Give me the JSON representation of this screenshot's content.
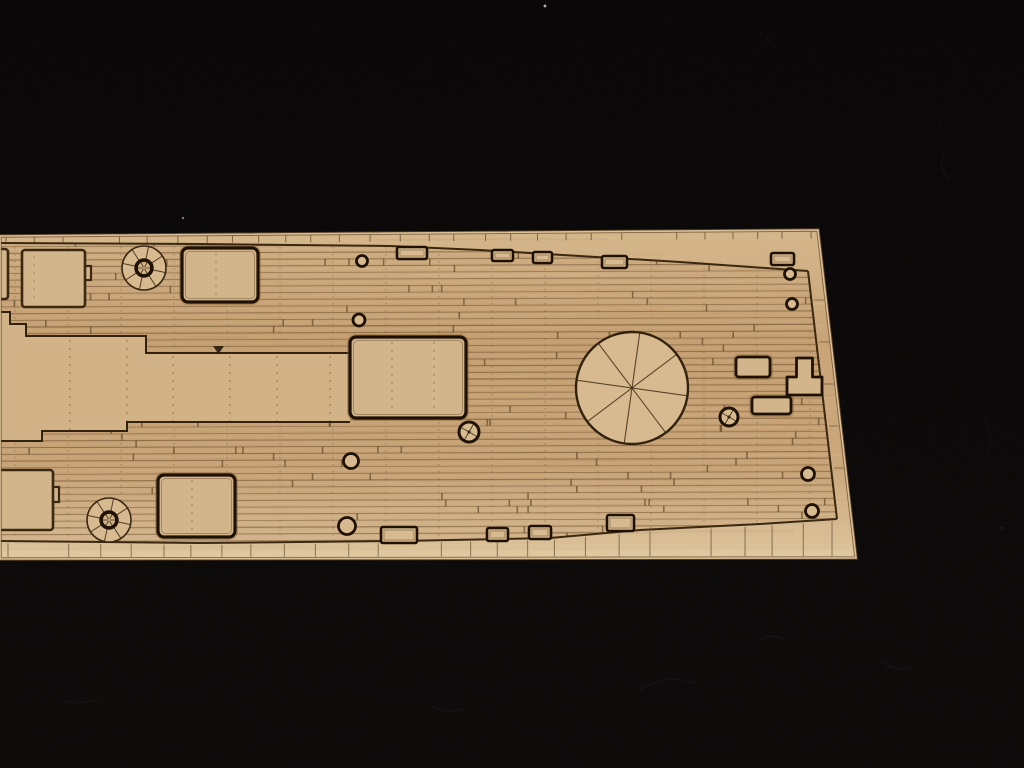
{
  "meta": {
    "description": "Close-up photograph of a laser-etched wooden model ship deck sheet lying on black fabric"
  },
  "scene": {
    "canvas": {
      "width": 1024,
      "height": 768,
      "background": "#060304",
      "background_low": "#0a0707"
    },
    "specks": [
      {
        "x": 545,
        "y": 6,
        "r": 1.4,
        "color": "#ccd3ce",
        "o": 0.85
      },
      {
        "x": 183,
        "y": 218,
        "r": 1.1,
        "color": "#b9a98c",
        "o": 0.8
      },
      {
        "x": 768,
        "y": 40,
        "r": 0.9,
        "color": "#3c3438",
        "o": 0.8
      },
      {
        "x": 1002,
        "y": 528,
        "r": 1.0,
        "color": "#3a3136",
        "o": 0.7
      },
      {
        "x": 120,
        "y": 648,
        "r": 1.0,
        "color": "#332c30",
        "o": 0.6
      },
      {
        "x": 940,
        "y": 126,
        "r": 0.8,
        "color": "#342d31",
        "o": 0.6
      }
    ],
    "fuzz": [
      {
        "d": "M640,690 q30,-18 55,-6"
      },
      {
        "d": "M430,705 q18,10 36,3"
      },
      {
        "d": "M880,660 q14,12 30,8"
      },
      {
        "d": "M985,420 q10,18 2,34"
      },
      {
        "d": "M60,700 q22,6 40,-2"
      },
      {
        "d": "M945,150 q-8,16 4,30"
      },
      {
        "d": "M760,640 q16,-8 28,2"
      }
    ],
    "fuzz_color": "#241f22",
    "wood": {
      "outline": [
        [
          0,
          236
        ],
        [
          818,
          230
        ],
        [
          856,
          558
        ],
        [
          0,
          559
        ]
      ],
      "gradient": [
        "#d5b78c",
        "#c8a477",
        "#cba87c",
        "#ddc39c"
      ],
      "edge_stroke": "#e6cca3",
      "edge_dark": "#6b4e2d",
      "bottom_face": [
        [
          0,
          551
        ],
        [
          856,
          550
        ],
        [
          856,
          559
        ],
        [
          0,
          560
        ]
      ],
      "bottom_face_color": "#e0c8a2",
      "grain_light": "#ecd7b2",
      "grain_dark": "#9d7950",
      "grain_count": 90,
      "grain_seed": 7
    },
    "deck": {
      "top": [
        [
          0,
          243
        ],
        [
          200,
          244
        ],
        [
          390,
          246
        ],
        [
          480,
          250
        ],
        [
          563,
          255
        ],
        [
          680,
          262
        ],
        [
          808,
          271
        ]
      ],
      "right": [
        [
          808,
          271
        ],
        [
          837,
          519
        ]
      ],
      "bottom": [
        [
          0,
          541
        ],
        [
          200,
          543
        ],
        [
          400,
          541
        ],
        [
          550,
          538
        ],
        [
          640,
          530
        ],
        [
          760,
          524
        ],
        [
          837,
          519
        ]
      ],
      "line_color": "#3a2810",
      "plank": {
        "spacing": 6.7,
        "top_y": 240,
        "bottom_y": 552,
        "seam_color": "#6e5231",
        "light_color": "#e4c99e",
        "tint_color": "#b08457",
        "tint_opacity": 0.16,
        "butt_color": "#4a3315",
        "butt_count": 170,
        "butt_seed": 3,
        "dot_col_step": 53,
        "dot_col_color": "#5d4223"
      }
    },
    "band": {
      "top_path": [
        [
          0,
          312
        ],
        [
          10,
          312
        ],
        [
          10,
          324
        ],
        [
          26,
          324
        ],
        [
          26,
          336
        ],
        [
          146,
          336
        ],
        [
          146,
          353
        ],
        [
          350,
          353
        ]
      ],
      "bottom_path": [
        [
          0,
          441
        ],
        [
          42,
          441
        ],
        [
          42,
          431
        ],
        [
          127,
          431
        ],
        [
          127,
          422
        ],
        [
          350,
          422
        ]
      ],
      "fill": "#d2b388",
      "outline": "#33220e",
      "dash_cols": [
        70,
        127,
        173,
        230,
        277,
        330
      ],
      "dash_color": "#6b4d2a"
    },
    "ticks": {
      "color": "#4f3a1e",
      "top_step": 24,
      "bottom_step": 26,
      "len": 7,
      "seed": 11
    },
    "etch": {
      "line": "#3a2810",
      "deep": "#1f1204",
      "halo": "#8a6434",
      "inner": "#6b4d2a",
      "fill": "#d3b58b",
      "fill_light": "#d7ba90"
    },
    "features": [
      {
        "type": "prect",
        "name": "etched-rect-left-edge-top",
        "x": -16,
        "y": 249,
        "w": 24,
        "h": 50
      },
      {
        "type": "hrect",
        "name": "etched-deckhouse-topleft",
        "x": 22,
        "y": 250,
        "w": 63,
        "h": 57,
        "bump": [
          82,
          266,
          9,
          14
        ]
      },
      {
        "type": "capstan",
        "name": "etched-capstan-fore",
        "cx": 144,
        "cy": 268,
        "r": 22
      },
      {
        "type": "hatch",
        "name": "etched-hatch-topmid",
        "x": 182,
        "y": 248,
        "w": 76,
        "h": 54,
        "dash_cols": [
          216
        ]
      },
      {
        "type": "ring",
        "name": "etched-ringbolt",
        "cx": 362,
        "cy": 261,
        "r": 5.5
      },
      {
        "type": "ring",
        "name": "etched-ringbolt",
        "cx": 359,
        "cy": 320,
        "r": 6
      },
      {
        "type": "edgerect",
        "name": "etched-fitting-topedge",
        "x": 397,
        "y": 247,
        "w": 30,
        "h": 12
      },
      {
        "type": "edgerect",
        "name": "etched-fitting-topedge",
        "x": 492,
        "y": 250,
        "w": 21,
        "h": 11
      },
      {
        "type": "edgerect",
        "name": "etched-fitting-topedge",
        "x": 533,
        "y": 252,
        "w": 19,
        "h": 11
      },
      {
        "type": "edgerect",
        "name": "etched-fitting-topedge",
        "x": 602,
        "y": 256,
        "w": 25,
        "h": 12
      },
      {
        "type": "edgerect",
        "name": "etched-fitting-topedge",
        "x": 771,
        "y": 253,
        "w": 23,
        "h": 12
      },
      {
        "type": "hatch",
        "name": "etched-central-hatch",
        "x": 350,
        "y": 337,
        "w": 116,
        "h": 81,
        "dash_cols": [
          392,
          434
        ]
      },
      {
        "type": "blob",
        "name": "etched-notch",
        "x": 213,
        "y": 346,
        "w": 11,
        "h": 8
      },
      {
        "type": "barbette",
        "name": "etched-barbette-circle",
        "cx": 632,
        "cy": 388,
        "r": 56
      },
      {
        "type": "winch",
        "name": "etched-winch",
        "cx": 469,
        "cy": 432,
        "r": 10
      },
      {
        "type": "winch",
        "name": "etched-winch",
        "cx": 729,
        "cy": 417,
        "r": 9
      },
      {
        "type": "ring",
        "name": "etched-ringbolt",
        "cx": 790,
        "cy": 274,
        "r": 5.5
      },
      {
        "type": "ring",
        "name": "etched-ringbolt",
        "cx": 792,
        "cy": 304,
        "r": 5.5
      },
      {
        "type": "rect2",
        "name": "etched-fitting-right",
        "x": 736,
        "y": 357,
        "w": 34,
        "h": 20
      },
      {
        "type": "rect2",
        "name": "etched-fitting-right",
        "x": 752,
        "y": 397,
        "w": 39,
        "h": 17
      },
      {
        "type": "tee",
        "name": "etched-tee-fitting",
        "x": 787,
        "y": 358,
        "stem_w": 16,
        "stem_h": 19,
        "base_w": 35,
        "base_h": 18
      },
      {
        "type": "ring",
        "name": "etched-ringbolt",
        "cx": 808,
        "cy": 474,
        "r": 6.5
      },
      {
        "type": "ring",
        "name": "etched-ringbolt",
        "cx": 812,
        "cy": 511,
        "r": 6.5
      },
      {
        "type": "ring",
        "name": "etched-ringbolt",
        "cx": 351,
        "cy": 461,
        "r": 7.5
      },
      {
        "type": "ring",
        "name": "etched-ringbolt",
        "cx": 347,
        "cy": 526,
        "r": 8.5
      },
      {
        "type": "hrect",
        "name": "etched-deckhouse-bottomleft",
        "x": -16,
        "y": 470,
        "w": 69,
        "h": 60,
        "bump": [
          50,
          487,
          9,
          15
        ]
      },
      {
        "type": "capstan",
        "name": "etched-capstan-aft",
        "cx": 109,
        "cy": 520,
        "r": 22
      },
      {
        "type": "hatch",
        "name": "etched-hatch-bottomleft",
        "x": 158,
        "y": 475,
        "w": 77,
        "h": 62,
        "dash_cols": [
          192
        ]
      },
      {
        "type": "edgerect",
        "name": "etched-fitting-bottomedge",
        "x": 381,
        "y": 527,
        "w": 36,
        "h": 16
      },
      {
        "type": "edgerect",
        "name": "etched-fitting-bottomedge",
        "x": 487,
        "y": 528,
        "w": 21,
        "h": 13
      },
      {
        "type": "edgerect",
        "name": "etched-fitting-bottomedge",
        "x": 529,
        "y": 526,
        "w": 22,
        "h": 13
      },
      {
        "type": "edgerect",
        "name": "etched-fitting-bottomedge",
        "x": 607,
        "y": 515,
        "w": 27,
        "h": 16
      }
    ]
  }
}
